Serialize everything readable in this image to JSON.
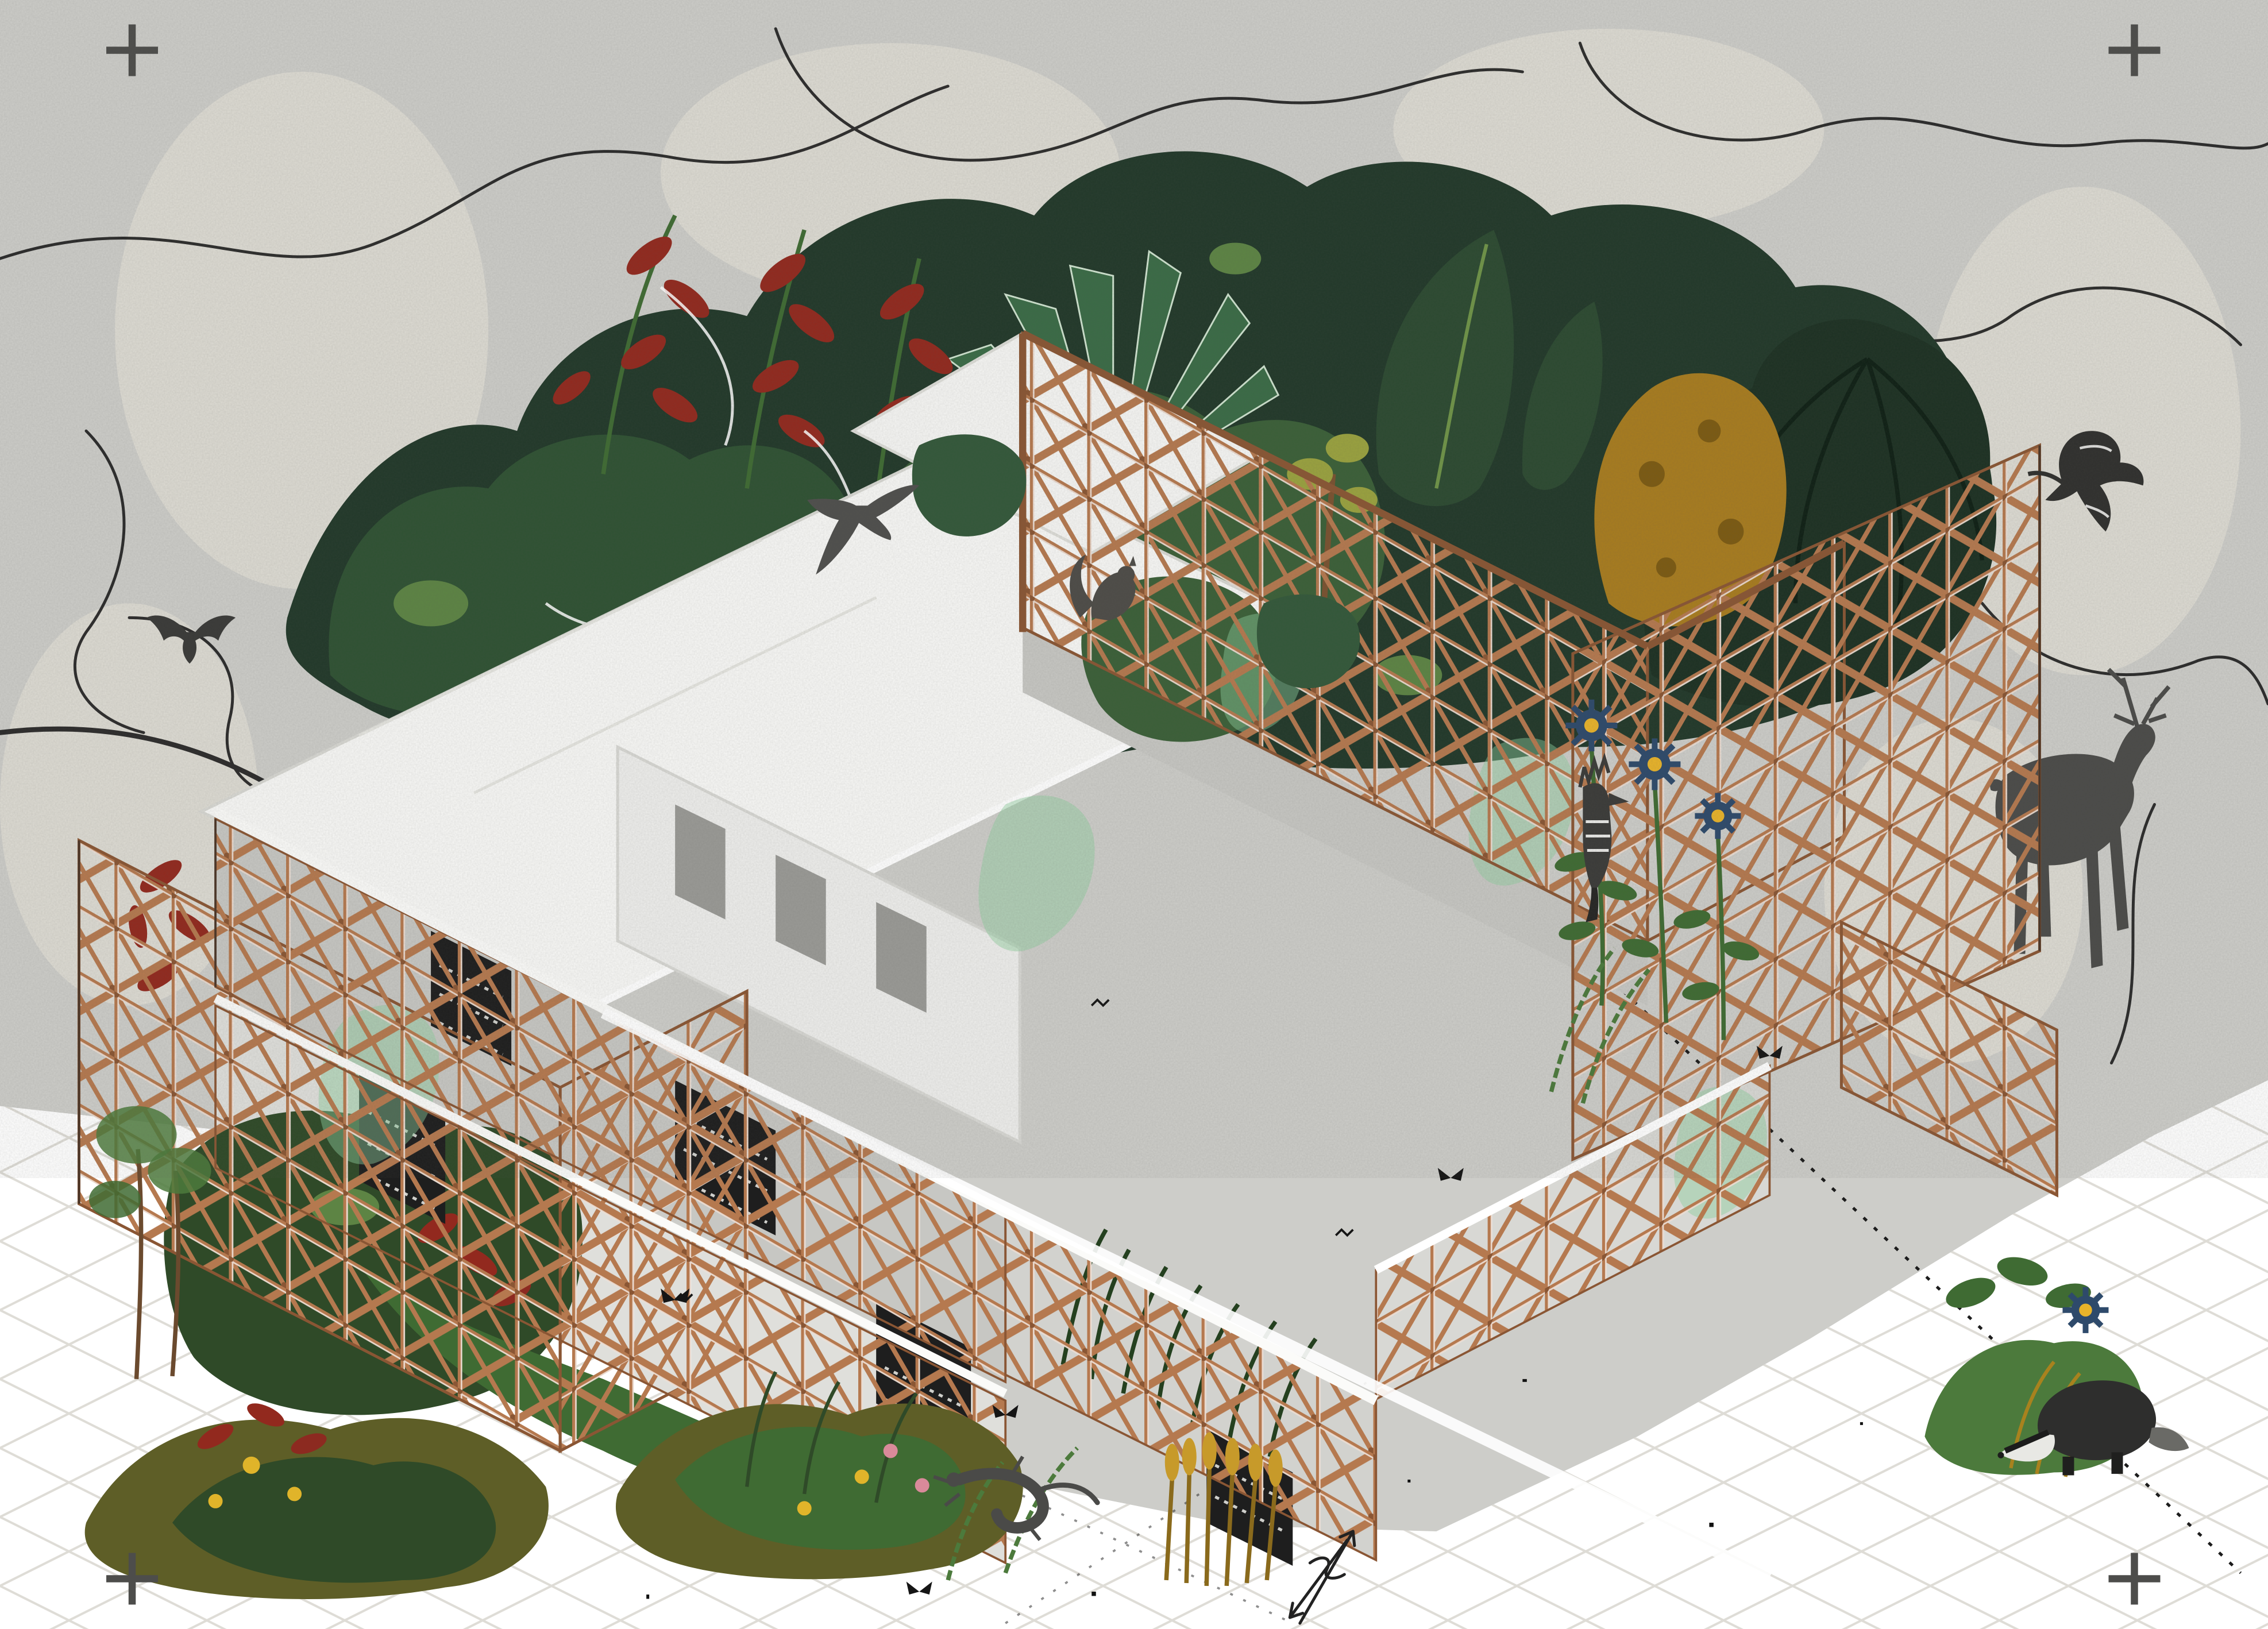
{
  "scene": {
    "type": "architectural-axonometric-collage",
    "title": "Timber diagrid pavilion overgrown with plants and wildlife",
    "palette": {
      "bg": "#cdcdc9",
      "bg_patch": "#e8e5da",
      "scribble": "#1a1a1a",
      "white_squiggle": "#ffffff",
      "ground": "#ffffff",
      "grid": "#dedcd6",
      "dashed_line": "#1c1c1c",
      "copper": "#b5794f",
      "copper_dark": "#8a5634",
      "roof": "#f8f8f6",
      "roof_edge": "#d8d8d3",
      "wall": "#c7c7c3",
      "wall_light": "#dfdfdb",
      "slab": "#fbfbf9",
      "interior_wall": "#eeeeec",
      "opening": "#9a9a96",
      "panel_dark": "#1e1e1e",
      "jungle_dark": "#22392a",
      "jungle_mid": "#2f5233",
      "jungle_green": "#3b6038",
      "palm_dark": "#1d3123",
      "leaf_green": "#3f6b33",
      "leaf_light": "#5d8444",
      "fern_green": "#4c7a3c",
      "grass_dark": "#24401f",
      "mint": "#8ecf9e",
      "red_plant": "#92291e",
      "maroon": "#4e332a",
      "ochre": "#a87c1f",
      "ochre_dark": "#7c5a12",
      "olive": "#5e5e27",
      "wheat": "#c79a2a",
      "wheat_stem": "#8a6a1c",
      "blue_flower": "#2e4a6b",
      "flower_center": "#e8b32a",
      "yellow_flower": "#e0b42a",
      "pink_flower": "#d98a9a",
      "animal": "#4b4b49",
      "animal_dark": "#2e2e2d",
      "animal_light": "#e8e8e4",
      "reg_mark": "#4d4d4b",
      "sketch": "#222222",
      "trunk": "#6b4a2e"
    },
    "registration_marks": {
      "count": 4,
      "positions": [
        "top-left",
        "top-right",
        "bottom-left",
        "bottom-right"
      ]
    },
    "structure": [
      {
        "name": "timber-diagrid-lattice",
        "note": "copper-toned triangulated timber screens on every facade and rooftop pergola"
      },
      {
        "name": "white-roof-slabs",
        "note": "flat white roof planes"
      },
      {
        "name": "concrete-wall-bands",
        "note": "grey textured wall strips between floors"
      },
      {
        "name": "dark-screen-panels",
        "note": "perforated dark infill panels with glyph-like pattern"
      },
      {
        "name": "isometric-ground-grid",
        "note": "faint grey diagonal grid on white ground with dotted survey line"
      },
      {
        "name": "hand-sketch-arrow",
        "note": "pencil double arrow near bottom centre"
      },
      {
        "name": "contour-scribbles",
        "note": "black hand-drawn wandering lines over grainy grey forest backdrop"
      }
    ],
    "animals": [
      {
        "name": "deer",
        "location": "right, standing behind lattice wing"
      },
      {
        "name": "badger",
        "location": "bottom right, walking on ground"
      },
      {
        "name": "squirrel",
        "location": "on pergola lattice rim, centre"
      },
      {
        "name": "hoopoe-perched",
        "location": "centre right, on lattice"
      },
      {
        "name": "hoopoe-flying",
        "location": "top right sky"
      },
      {
        "name": "swallow-flying",
        "location": "above left roof slab"
      },
      {
        "name": "bat",
        "location": "left edge, mid height"
      },
      {
        "name": "lizard",
        "location": "bottom centre on white ground"
      },
      {
        "name": "butterflies",
        "location": "scattered across facade and ground",
        "count": 5
      }
    ],
    "plants": [
      {
        "name": "red-heliconia",
        "location": "upper left backdrop and left lattice"
      },
      {
        "name": "agave-rosette",
        "location": "behind pergola, top centre"
      },
      {
        "name": "tropical-canopy",
        "location": "dense band behind building"
      },
      {
        "name": "ochre-tree",
        "location": "right of pergola"
      },
      {
        "name": "palm-cluster",
        "location": "top right backdrop"
      },
      {
        "name": "blue-daisies",
        "location": "right lattice bay"
      },
      {
        "name": "ferns-and-grasses",
        "location": "bottom centre beds"
      },
      {
        "name": "golden-wheat",
        "location": "bottom centre"
      },
      {
        "name": "yellow-flowers",
        "location": "bottom left beds"
      },
      {
        "name": "pink-flowers",
        "location": "bottom centre beds"
      },
      {
        "name": "mint-leaf-washes",
        "location": "translucent green accents over lattice"
      },
      {
        "name": "young-trees",
        "location": "far left foreground"
      }
    ]
  }
}
